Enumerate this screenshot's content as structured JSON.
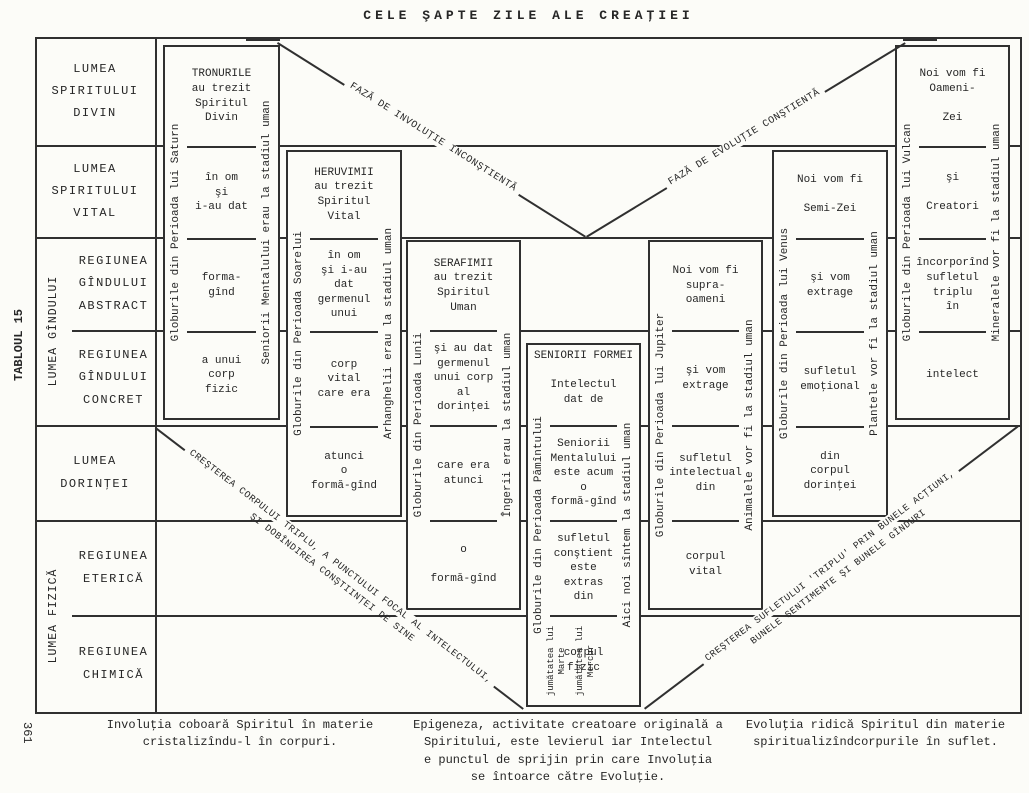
{
  "title": "CELE ŞAPTE ZILE ALE CREAŢIEI",
  "side_label": "TABLOUL 15",
  "page_number": "361",
  "world_rows": [
    {
      "label": "LUMEA\nSPIRITULUI\nDIVIN"
    },
    {
      "label": "LUMEA\nSPIRITULUI\nVITAL"
    },
    {
      "label": "REGIUNEA\nGÎNDULUI\nABSTRACT"
    },
    {
      "label": "REGIUNEA\nGÎNDULUI\nCONCRET"
    },
    {
      "label": "LUMEA\nDORINŢEI"
    },
    {
      "label": "REGIUNEA\nETERICĂ"
    },
    {
      "label": "REGIUNEA\nCHIMICĂ"
    }
  ],
  "row_groups": [
    {
      "label": "LUMEA GÎNDULUI"
    },
    {
      "label": "LUMEA FIZICĂ"
    }
  ],
  "phases": {
    "involution": "FAZĂ DE INVOLUŢIE INCONŞTIENTĂ",
    "evolution": "FAZĂ DE EVOLUŢIE CONŞTIENTĂ",
    "growth_left_line1": "CREŞTEREA CORPULUI TRIPLU, A PUNCTULUI FOCAL AL INTELECTULUI,",
    "growth_left_line2": "ŞI DOBÎNDIREA CONŞTIINŢEI DE SINE",
    "growth_right_line1": "CREŞTEREA SUFLETULUI 'TRIPLU' PRIN BUNELE ACŢIUNI,",
    "growth_right_line2": "BUNELE SENTIMENTE ŞI BUNELE GÎNDURI"
  },
  "periods": [
    {
      "name": "saturn",
      "left_label": "Globurile din Perioada lui Saturn",
      "right_label": "Seniorii Mentalului erau la stadiul uman",
      "cells": [
        "TRONURILE\nau trezit\nSpiritul\nDivin",
        "în om\nşi\ni-au dat",
        "forma-\ngînd",
        "a unui\ncorp\nfizic"
      ]
    },
    {
      "name": "soare",
      "left_label": "Globurile din Perioada Soarelui",
      "right_label": "Arhanghelii erau la stadiul uman",
      "cells": [
        "HERUVIMII\nau trezit\nSpiritul\nVital",
        "în om\nşi i-au dat\ngermenul\nunui",
        "corp\nvital\ncare era",
        "atunci\no\nformă-gînd"
      ]
    },
    {
      "name": "luna",
      "left_label": "Globurile din Perioada Lunii",
      "right_label": "Îngerii erau la stadiul uman",
      "cells": [
        "SERAFIMII\nau trezit\nSpiritul\nUman",
        "şi au dat\ngermenul\nunui corp\nal dorinţei",
        "care era\natunci",
        "o\n\nformă-gînd"
      ]
    },
    {
      "name": "pamint",
      "header": "SENIORII FORMEI",
      "left_label": "Globurile din Perioada Pămîntului",
      "right_label": "Aici noi sîntem la stadiul uman",
      "left_sub_label": "jumătatea lui\nMarte",
      "right_sub_label": "jumătatea lui\nMercur",
      "cells": [
        "Intelectul\ndat de",
        "Seniorii\nMentalului\neste acum o\nformă-gînd",
        "sufletul\nconştient\neste extras\ndin",
        "corpul\nfizic"
      ]
    },
    {
      "name": "jupiter",
      "left_label": "Globurile din Perioada lui Jupiter",
      "right_label": "Animalele vor fi la stadiul uman",
      "cells": [
        "Noi vom fi\nsupra-\noameni",
        "şi vom\nextrage",
        "sufletul\nintelectual\ndin",
        "corpul\nvital"
      ]
    },
    {
      "name": "venus",
      "left_label": "Globurile din Perioada lui Venus",
      "right_label": "Plantele vor fi la stadiul uman",
      "cells": [
        "Noi vom fi\n\nSemi-Zei",
        "şi vom\nextrage",
        "sufletul\nemoţional",
        "din\ncorpul\ndorinţei"
      ]
    },
    {
      "name": "vulcan",
      "left_label": "Globurile din Perioada lui Vulcan",
      "right_label": "Mineralele vor fi la stadiul uman",
      "cells": [
        "Noi vom fi\nOameni-\n\nZei",
        "şi\n\nCreatori",
        "încorporînd\nsufletul\ntriplu\nîn",
        "intelect"
      ]
    }
  ],
  "captions": {
    "left": "Involuţia coboară Spiritul în materie\ncristalizîndu-l în corpuri.",
    "center": "Epigeneza, activitate creatoare originală a\nSpiritului, este levierul iar Intelectul\ne punctul de sprijin prin care Involuţia\nse întoarce către Evoluţie.",
    "right": "Evoluţia ridică Spiritul din materie\nspiritualizîndcorpurile în suflet."
  }
}
